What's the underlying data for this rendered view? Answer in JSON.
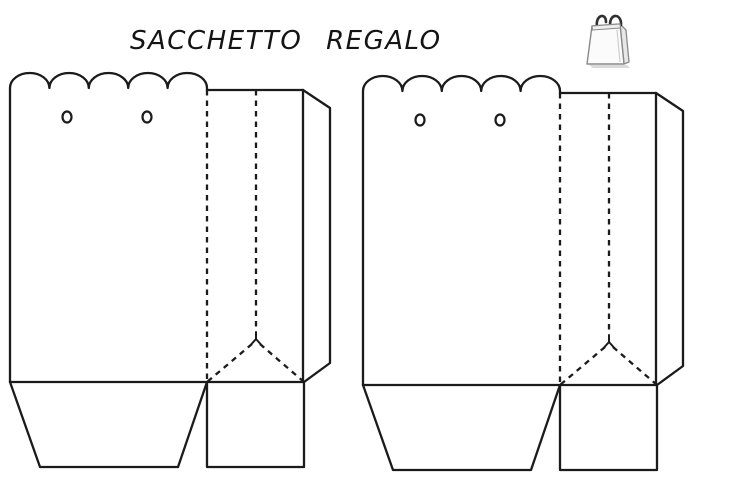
{
  "page": {
    "title": "SACCHETTO REGALO",
    "background": "#ffffff"
  },
  "colors": {
    "line": "#1b1b1b",
    "icon_outline": "#8a8a8a",
    "icon_handle": "#303030",
    "icon_body": "#fbfbfb",
    "icon_shade": "#e7e7e7",
    "icon_shadow": "#d9d9d9"
  },
  "icons": {
    "gift_bag": "gift-bag-icon"
  },
  "diagram": {
    "kind": "gift bag paper craft cut-and-fold template",
    "templates": [
      {
        "name": "left-bag-template",
        "scallop_count": 5,
        "punch_hole_count": 2
      },
      {
        "name": "right-bag-template",
        "scallop_count": 5,
        "punch_hole_count": 2
      }
    ]
  }
}
